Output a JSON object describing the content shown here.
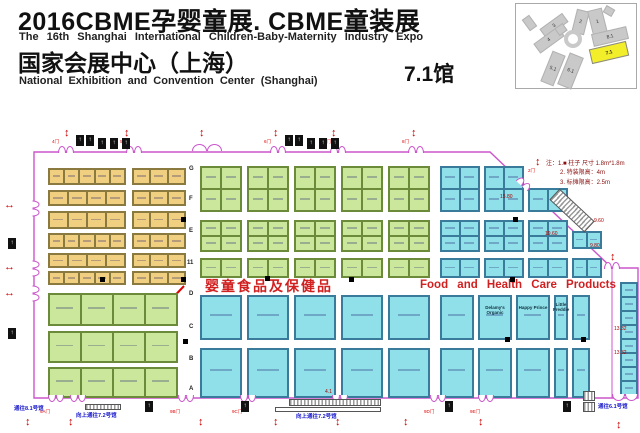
{
  "header": {
    "title_zh": "2016CBME孕婴童展. CBME童装展",
    "subtitle_en": "The 16th  Shanghai  International  Children-Baby-Maternity   Industry  Expo",
    "venue_zh": "国家会展中心（上海）",
    "venue_en": "National  Exhibition and  Convention  Center  (Shanghai)",
    "hall_label": "7.1馆"
  },
  "legend": {
    "line1": "注：1.■  柱子  尺寸 1.8m*1.8m",
    "line2": "2.  特装限高：4m",
    "line3": "3.  标摊限高：2.5m"
  },
  "minimap": {
    "halls": [
      {
        "label": "2",
        "x": 58,
        "y": 6,
        "w": 13,
        "h": 24,
        "rot": 14
      },
      {
        "label": "1",
        "x": 74,
        "y": 5,
        "w": 15,
        "h": 26,
        "rot": -14
      },
      {
        "label": "3",
        "x": 24,
        "y": 16,
        "w": 28,
        "h": 11,
        "rot": -36
      },
      {
        "label": "4",
        "x": 18,
        "y": 30,
        "w": 30,
        "h": 12,
        "rot": -36
      },
      {
        "label": "8.1",
        "x": 76,
        "y": 26,
        "w": 36,
        "h": 13,
        "rot": -13
      },
      {
        "label": "7.1",
        "x": 74,
        "y": 41,
        "w": 38,
        "h": 15,
        "rot": -13,
        "hl": true
      },
      {
        "label": "5.1",
        "x": 30,
        "y": 48,
        "w": 14,
        "h": 33,
        "rot": 22
      },
      {
        "label": "6.1",
        "x": 47,
        "y": 50,
        "w": 15,
        "h": 34,
        "rot": 22
      },
      {
        "label": "",
        "x": 88,
        "y": 3,
        "w": 10,
        "h": 8,
        "rot": 30
      },
      {
        "label": "",
        "x": 9,
        "y": 12,
        "w": 9,
        "h": 14,
        "rot": -36
      },
      {
        "label": "",
        "x": 40,
        "y": 21,
        "w": 10,
        "h": 9,
        "rot": -36
      }
    ],
    "ring": {
      "x": 48,
      "y": 26
    }
  },
  "floorplan": {
    "zone_label_zh": "婴童食品及保健品",
    "zone_label_en": "Food  and  Health  Care  Products",
    "colors": {
      "Y": {
        "fill": "#f0cf80",
        "line": "#8a7a40"
      },
      "G": {
        "fill": "#cbe79b",
        "line": "#6b8a3a"
      },
      "C": {
        "fill": "#8fe0e8",
        "line": "#3a7a9a"
      }
    },
    "boundary": {
      "points": "34,152 490,152 612,268 638,268 638,398 34,398",
      "color": "#cc55cc"
    },
    "inner_walls": [
      [
        612,
        268,
        612,
        398
      ]
    ],
    "annotation_arrow": {
      "from": [
        184,
        286
      ],
      "to": [
        164,
        307
      ],
      "color": "#e00000"
    },
    "blocks": [
      [
        48,
        168,
        78,
        17,
        1,
        5,
        "Y"
      ],
      [
        48,
        190,
        78,
        16,
        1,
        4,
        "Y"
      ],
      [
        48,
        211,
        78,
        18,
        1,
        4,
        "Y"
      ],
      [
        48,
        233,
        78,
        16,
        1,
        5,
        "Y"
      ],
      [
        48,
        253,
        78,
        15,
        1,
        4,
        "Y"
      ],
      [
        48,
        271,
        78,
        14,
        1,
        5,
        "Y"
      ],
      [
        132,
        168,
        54,
        17,
        1,
        3,
        "Y"
      ],
      [
        132,
        190,
        54,
        16,
        1,
        3,
        "Y"
      ],
      [
        132,
        211,
        54,
        18,
        1,
        3,
        "Y"
      ],
      [
        132,
        233,
        54,
        16,
        1,
        3,
        "Y"
      ],
      [
        132,
        253,
        54,
        15,
        1,
        3,
        "Y"
      ],
      [
        132,
        271,
        54,
        14,
        1,
        3,
        "Y"
      ],
      [
        200,
        166,
        42,
        46,
        2,
        2,
        "G"
      ],
      [
        200,
        220,
        42,
        32,
        2,
        2,
        "G"
      ],
      [
        200,
        258,
        42,
        20,
        1,
        2,
        "G"
      ],
      [
        247,
        166,
        42,
        46,
        2,
        2,
        "G"
      ],
      [
        247,
        220,
        42,
        32,
        2,
        2,
        "G"
      ],
      [
        247,
        258,
        42,
        20,
        1,
        2,
        "G"
      ],
      [
        294,
        166,
        42,
        46,
        2,
        2,
        "G"
      ],
      [
        294,
        220,
        42,
        32,
        2,
        2,
        "G"
      ],
      [
        294,
        258,
        42,
        20,
        1,
        2,
        "G"
      ],
      [
        341,
        166,
        42,
        46,
        2,
        2,
        "G"
      ],
      [
        341,
        220,
        42,
        32,
        2,
        2,
        "G"
      ],
      [
        341,
        258,
        42,
        20,
        1,
        2,
        "G"
      ],
      [
        388,
        166,
        42,
        46,
        2,
        2,
        "G"
      ],
      [
        388,
        220,
        42,
        32,
        2,
        2,
        "G"
      ],
      [
        388,
        258,
        42,
        20,
        1,
        2,
        "G"
      ],
      [
        440,
        166,
        40,
        46,
        2,
        2,
        "C"
      ],
      [
        440,
        220,
        40,
        32,
        2,
        2,
        "C"
      ],
      [
        440,
        258,
        40,
        20,
        1,
        2,
        "C"
      ],
      [
        484,
        166,
        40,
        46,
        2,
        2,
        "C"
      ],
      [
        484,
        220,
        40,
        32,
        2,
        2,
        "C"
      ],
      [
        484,
        258,
        40,
        20,
        1,
        2,
        "C"
      ],
      [
        528,
        188,
        40,
        24,
        1,
        2,
        "C"
      ],
      [
        528,
        220,
        40,
        32,
        2,
        2,
        "C"
      ],
      [
        528,
        258,
        40,
        20,
        1,
        2,
        "C"
      ],
      [
        572,
        231,
        30,
        18,
        1,
        2,
        "C"
      ],
      [
        572,
        258,
        30,
        20,
        1,
        2,
        "C"
      ],
      [
        48,
        293,
        130,
        33,
        1,
        4,
        "G"
      ],
      [
        48,
        331,
        130,
        32,
        1,
        4,
        "G"
      ],
      [
        48,
        367,
        130,
        31,
        1,
        4,
        "G"
      ],
      [
        200,
        295,
        42,
        45,
        1,
        1,
        "C"
      ],
      [
        200,
        348,
        42,
        50,
        1,
        1,
        "C"
      ],
      [
        247,
        295,
        42,
        45,
        1,
        1,
        "C"
      ],
      [
        247,
        348,
        42,
        50,
        1,
        1,
        "C"
      ],
      [
        294,
        295,
        42,
        45,
        1,
        1,
        "C"
      ],
      [
        294,
        348,
        42,
        50,
        1,
        1,
        "C"
      ],
      [
        341,
        295,
        42,
        45,
        1,
        1,
        "C"
      ],
      [
        341,
        348,
        42,
        50,
        1,
        1,
        "C"
      ],
      [
        388,
        295,
        42,
        45,
        1,
        1,
        "C"
      ],
      [
        388,
        348,
        42,
        50,
        1,
        1,
        "C"
      ],
      [
        440,
        295,
        34,
        45,
        1,
        1,
        "C"
      ],
      [
        440,
        348,
        34,
        50,
        1,
        1,
        "C"
      ],
      [
        478,
        295,
        34,
        45,
        1,
        1,
        "C"
      ],
      [
        478,
        348,
        34,
        50,
        1,
        1,
        "C"
      ],
      [
        516,
        295,
        34,
        45,
        1,
        1,
        "C"
      ],
      [
        516,
        348,
        34,
        50,
        1,
        1,
        "C"
      ],
      [
        554,
        295,
        14,
        45,
        1,
        1,
        "C"
      ],
      [
        554,
        348,
        14,
        50,
        1,
        1,
        "C"
      ],
      [
        572,
        295,
        18,
        45,
        1,
        1,
        "C"
      ],
      [
        572,
        348,
        18,
        50,
        1,
        1,
        "C"
      ],
      [
        620,
        282,
        18,
        114,
        8,
        1,
        "C"
      ]
    ],
    "booth_labels": [
      [
        495,
        305,
        34,
        "Delamy's Organic"
      ],
      [
        533,
        305,
        30,
        "Happy Prince"
      ],
      [
        561,
        302,
        16,
        "Little Freddie"
      ]
    ],
    "aisle_letters": [
      [
        189,
        166,
        "G"
      ],
      [
        189,
        196,
        "F"
      ],
      [
        189,
        228,
        "E"
      ],
      [
        187,
        260,
        "11"
      ],
      [
        189,
        291,
        "D"
      ],
      [
        189,
        324,
        "C"
      ],
      [
        189,
        356,
        "B"
      ],
      [
        189,
        386,
        "A"
      ]
    ],
    "pillars": [
      [
        181,
        217
      ],
      [
        513,
        217
      ],
      [
        100,
        277
      ],
      [
        181,
        277
      ],
      [
        265,
        276
      ],
      [
        349,
        277
      ],
      [
        510,
        277
      ],
      [
        183,
        339
      ],
      [
        505,
        337
      ],
      [
        581,
        337
      ]
    ],
    "arrows": [
      [
        64,
        128,
        "v"
      ],
      [
        124,
        128,
        "v"
      ],
      [
        199,
        128,
        "v"
      ],
      [
        273,
        128,
        "v"
      ],
      [
        331,
        128,
        "v"
      ],
      [
        411,
        128,
        "v"
      ],
      [
        535,
        157,
        "v"
      ],
      [
        610,
        252,
        "v"
      ],
      [
        25,
        417,
        "v"
      ],
      [
        68,
        417,
        "v"
      ],
      [
        198,
        417,
        "v"
      ],
      [
        273,
        417,
        "v"
      ],
      [
        335,
        417,
        "v"
      ],
      [
        403,
        417,
        "v"
      ],
      [
        478,
        417,
        "v"
      ],
      [
        616,
        420,
        "v"
      ],
      [
        4,
        200,
        "h"
      ],
      [
        4,
        262,
        "h"
      ],
      [
        4,
        288,
        "h"
      ]
    ],
    "gates": [
      [
        58,
        146,
        0,
        16
      ],
      [
        126,
        146,
        0,
        16
      ],
      [
        192,
        144,
        0,
        30
      ],
      [
        270,
        146,
        0,
        16
      ],
      [
        330,
        146,
        0,
        16
      ],
      [
        408,
        146,
        0,
        16
      ],
      [
        516,
        180,
        43,
        16
      ],
      [
        604,
        262,
        0,
        16
      ],
      [
        28,
        205,
        90,
        16
      ],
      [
        28,
        265,
        90,
        16
      ],
      [
        28,
        290,
        90,
        16
      ],
      [
        48,
        395,
        180,
        16
      ],
      [
        70,
        395,
        180,
        16
      ],
      [
        178,
        395,
        180,
        16
      ],
      [
        240,
        395,
        180,
        16
      ],
      [
        332,
        395,
        180,
        16
      ],
      [
        430,
        395,
        180,
        16
      ],
      [
        478,
        395,
        180,
        16
      ],
      [
        612,
        394,
        180,
        26
      ]
    ],
    "gate_labels": [
      [
        52,
        139,
        "4门"
      ],
      [
        120,
        139,
        "5门"
      ],
      [
        264,
        139,
        "6门"
      ],
      [
        324,
        139,
        "7门"
      ],
      [
        402,
        139,
        "8门"
      ],
      [
        528,
        168,
        "2门"
      ],
      [
        40,
        409,
        "9A门"
      ],
      [
        170,
        409,
        "9B门"
      ],
      [
        232,
        409,
        "9C门"
      ],
      [
        424,
        409,
        "9D门"
      ],
      [
        470,
        409,
        "9E门"
      ]
    ],
    "facility_icons": [
      [
        76,
        135
      ],
      [
        86,
        135
      ],
      [
        98,
        138
      ],
      [
        110,
        138
      ],
      [
        122,
        138
      ],
      [
        285,
        135
      ],
      [
        295,
        135
      ],
      [
        307,
        138
      ],
      [
        319,
        138
      ],
      [
        331,
        138
      ],
      [
        145,
        401
      ],
      [
        241,
        401
      ],
      [
        445,
        401
      ],
      [
        563,
        401
      ],
      [
        8,
        238
      ],
      [
        8,
        328
      ]
    ],
    "escalators": [
      [
        548,
        203,
        48,
        15,
        43,
        "s"
      ],
      [
        289,
        399,
        92,
        7,
        0,
        "s"
      ],
      [
        275,
        407,
        106,
        5,
        0,
        "o"
      ],
      [
        85,
        404,
        36,
        6,
        0,
        "s"
      ],
      [
        583,
        391,
        12,
        10,
        0,
        "s"
      ],
      [
        583,
        402,
        12,
        10,
        0,
        "s"
      ]
    ],
    "dims": [
      [
        500,
        194,
        "15.80"
      ],
      [
        594,
        218,
        "9.60"
      ],
      [
        545,
        231,
        "19.60"
      ],
      [
        590,
        243,
        "9.80"
      ],
      [
        614,
        326,
        "13.32"
      ],
      [
        614,
        350,
        "13.32"
      ],
      [
        325,
        389,
        "4.1"
      ]
    ],
    "exits": [
      [
        14,
        404,
        "通往8.1号馆"
      ],
      [
        76,
        411,
        "向上通往7.2号馆"
      ],
      [
        296,
        412,
        "向上通往7.2号馆"
      ],
      [
        598,
        402,
        "通往6.1号馆"
      ]
    ]
  }
}
